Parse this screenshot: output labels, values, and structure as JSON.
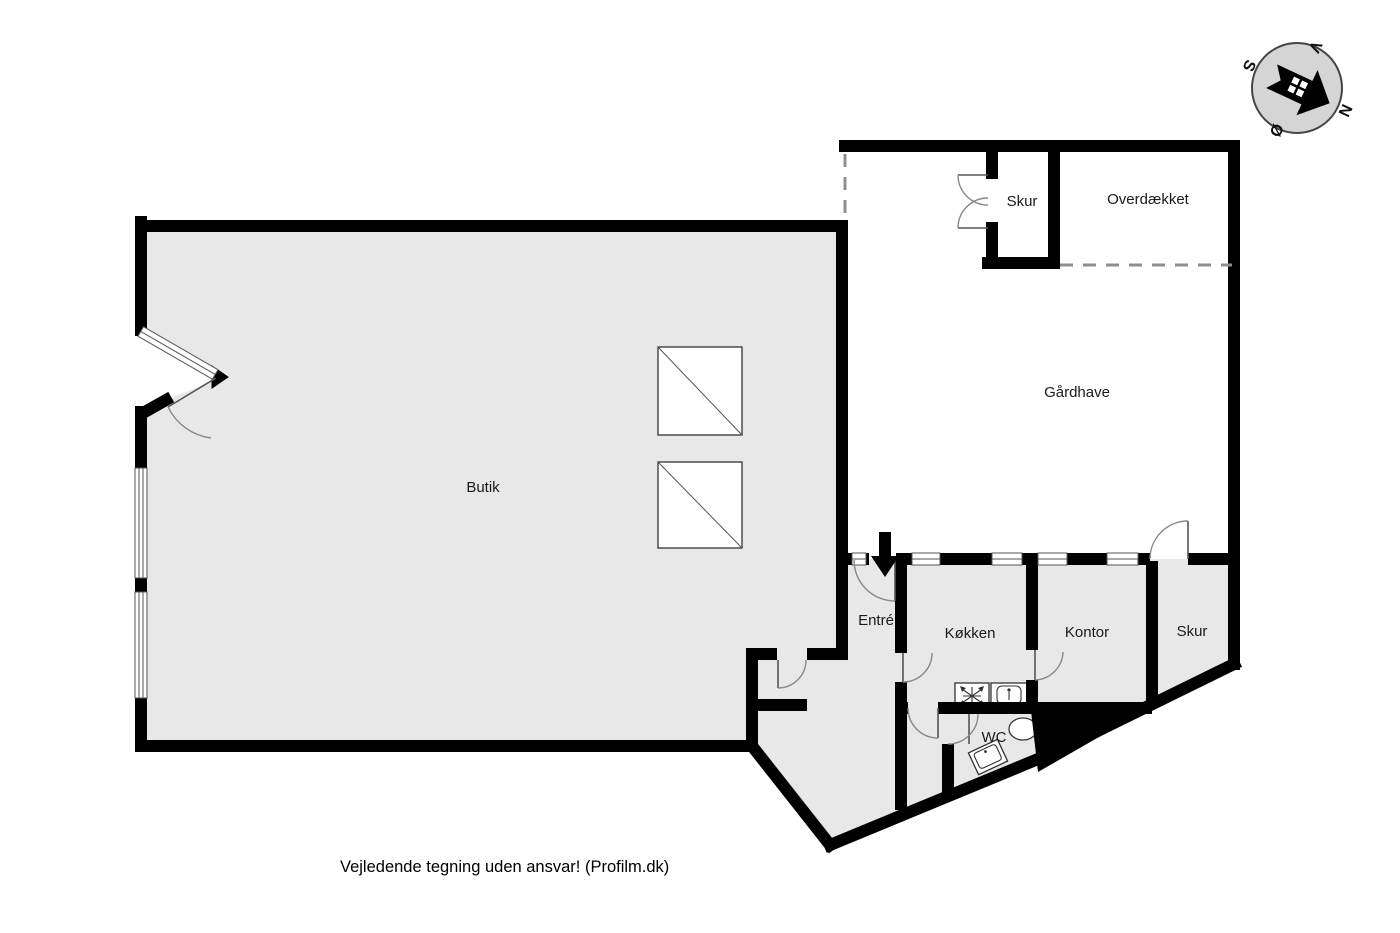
{
  "plan": {
    "rooms": [
      {
        "id": "butik",
        "label": "Butik"
      },
      {
        "id": "gaardhave",
        "label": "Gårdhave"
      },
      {
        "id": "skur-top",
        "label": "Skur"
      },
      {
        "id": "overdaekket",
        "label": "Overdækket"
      },
      {
        "id": "entre",
        "label": "Entré"
      },
      {
        "id": "koekken",
        "label": "Køkken"
      },
      {
        "id": "kontor",
        "label": "Kontor"
      },
      {
        "id": "skur-right",
        "label": "Skur"
      },
      {
        "id": "wc",
        "label": "WC"
      }
    ],
    "compass": {
      "north": "N",
      "south": "S",
      "east": "Ø",
      "west": "V"
    },
    "footer": {
      "disclaimer": "Vejledende tegning uden ansvar! (Profilm.dk)"
    },
    "colors": {
      "floor": "#e8e8e8",
      "wall": "#000000",
      "compass_face": "#d5d5d5",
      "background": "#ffffff"
    }
  }
}
